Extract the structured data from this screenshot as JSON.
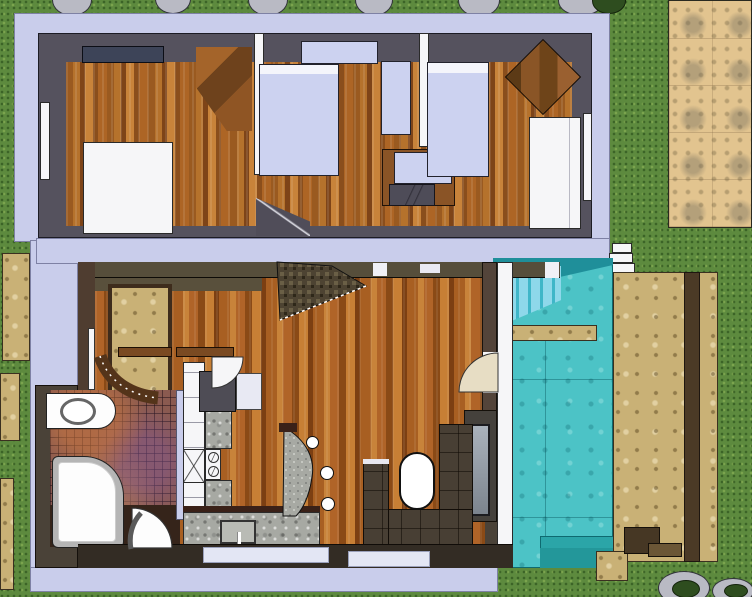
{
  "meta": {
    "title": "Two-storey house floor plan with pool — top-down 3D render",
    "render_style": "sketchup-top-view",
    "floors_shown": 2
  },
  "palette": {
    "grass": "#5d8a3e",
    "walkway_slab": "#c9cdeb",
    "upper_wall": "#55525e",
    "ground_wall": "#4a4238",
    "wood_light": "#c8833a",
    "wood_dark": "#7e4418",
    "pool_water": "#4cc3c6",
    "pool_steps": "#8ed8ea",
    "deck_stone": "#c9b176",
    "paving": "#e2c48f",
    "granite": "#a7a9a3",
    "mosaic_tile": "#8a5a50",
    "sofa": "#483f34",
    "bed_linen": "#ccd2f0",
    "fixture_white": "#f6f6f8",
    "bush_green": "#2e4d1f",
    "garden_stone": "#b9bac4"
  },
  "site": {
    "ground": "lawn grass",
    "stone_paving_area": "top-right corner terrace",
    "garden_stones_top_count": 6,
    "garden_stones_bottom_right_count": 2,
    "bushes": [
      "top-right",
      "bottom-right"
    ],
    "stepping_stones": "left edge of lot"
  },
  "upper_floor": {
    "label": "Upper floor — three bedrooms",
    "rooms": [
      {
        "name": "bedroom-left",
        "furniture": [
          "white-double-bed",
          "corner-wardrobe",
          "roof-window",
          "wall-window"
        ]
      },
      {
        "name": "bedroom-middle",
        "furniture": [
          "single-bed",
          "window-desk",
          "tall-cabinet",
          "desk-with-chair"
        ]
      },
      {
        "name": "bedroom-right",
        "furniture": [
          "single-bed",
          "corner-wardrobe",
          "white-closet",
          "wall-window"
        ]
      }
    ],
    "stair_opening": "bottom-center"
  },
  "ground_floor": {
    "label": "Ground floor — open plan living",
    "areas": [
      {
        "name": "entry-hall",
        "furniture": [
          "curved-console",
          "console-shelf",
          "armchair",
          "side-table",
          "interior-door",
          "stone-feature-window"
        ]
      },
      {
        "name": "bathroom",
        "furniture": [
          "vanity-with-basin",
          "walk-in-shower",
          "mosaic-floor",
          "arched-door"
        ]
      },
      {
        "name": "kitchen",
        "furniture": [
          "cabinet-run",
          "cooktop",
          "two-burners",
          "granite-counter",
          "sink-with-faucet",
          "curved-granite-bar",
          "bar-stools-x3"
        ]
      },
      {
        "name": "living-room",
        "furniture": [
          "u-shaped-sofa",
          "oval-coffee-table",
          "tv-panel",
          "patio-door-to-pool"
        ]
      },
      {
        "name": "staircase",
        "furniture": [
          "stair-flight"
        ]
      }
    ]
  },
  "pool": {
    "label": "Outdoor swimming pool",
    "features": [
      "underwater-stair-treads",
      "stone-plank-bridge",
      "corner-entry-steps",
      "timber-deck-strip",
      "stone-deck",
      "white-steps-to-walkway",
      "equipment-box"
    ]
  }
}
